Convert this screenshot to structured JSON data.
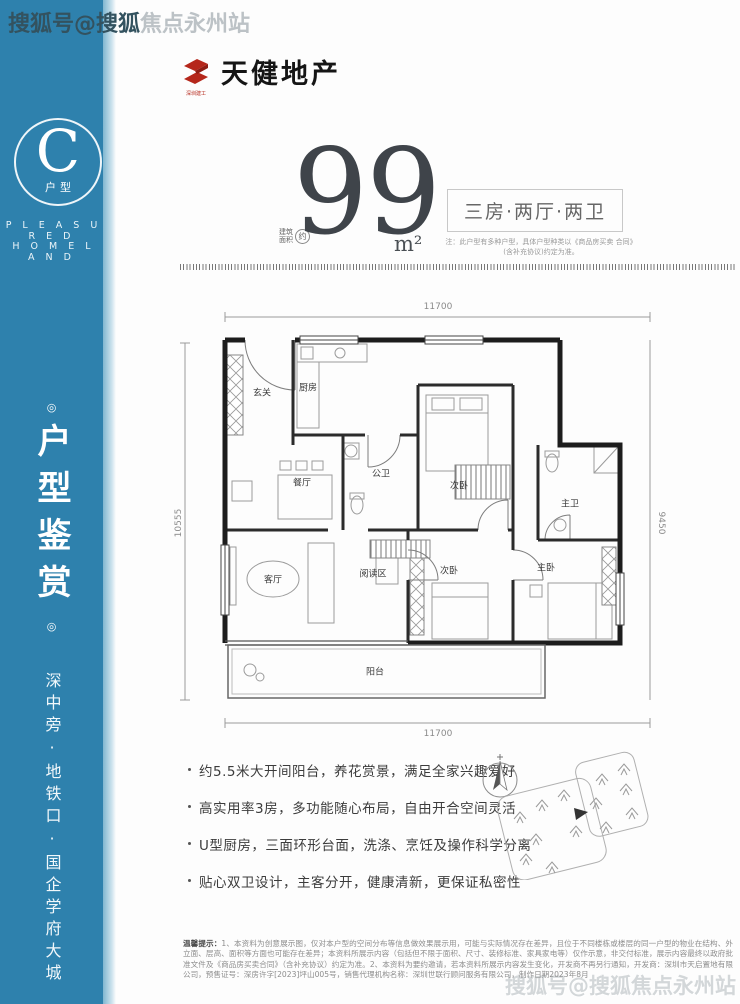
{
  "watermark": {
    "top_on_blue": "搜狐号@搜狐",
    "top_on_white": "焦点永州站",
    "bottom": "搜狐号@搜狐焦点永州站"
  },
  "header": {
    "logo_text": "天健地产",
    "logo_subtext": "深圳建工"
  },
  "sidebar": {
    "badge_letter": "C",
    "badge_label": "户型",
    "subtitle_line1": "P L E A S U R E D",
    "subtitle_line2": "H O M E L A N D",
    "ornament": "◎",
    "vertical_title": "户型鉴赏",
    "vertical_slogan": "深中旁·地铁口·国企学府大城"
  },
  "area": {
    "prefix_line1": "建筑",
    "prefix_line2": "面积",
    "prefix_circle": "约",
    "value": "99",
    "unit": "m²"
  },
  "layout_box": {
    "title": "三房·两厅·两卫",
    "note1": "注：此户型有多种户型，具体户型种类以《商品房买卖",
    "note2": "合同》(含补充协议)约定为准。"
  },
  "floorplan": {
    "dims": {
      "top": "11700",
      "bottom": "11700",
      "left": "10555",
      "right": "9450"
    },
    "rooms": [
      "玄关",
      "厨房",
      "公卫",
      "餐厅",
      "次卧",
      "主卫",
      "主卧",
      "次卧",
      "客厅",
      "阅读区",
      "阳台"
    ]
  },
  "features": [
    "约5.5米大开间阳台，养花赏景，满足全家兴趣爱好",
    "高实用率3房，多功能随心布局，自由开合空间灵活",
    "U型厨房，三面环形台面，洗涤、烹饪及操作科学分离",
    "贴心双卫设计，主客分开，健康清新，更保证私密性"
  ],
  "disclaimer": {
    "label": "温馨提示：",
    "lines": [
      "1、本资料为创意展示图，仅对本户型的空间分布等信息做效果展示用，可能与实际情况存在差异，且位于不同楼栋或楼层的同一户型的物业在结构、外立面、层",
      "高、面积等方面也可能存在差异；本资料所展示内容（包括但不限于面积、尺寸、装修标准、家具家电等）仅作示意，非交付标准，展示内容最终以政府批准文件及《商品",
      "房买卖合同》（含补充协议）约定为准。2、本资料为要约邀请，若本资料所展示内容发生变化，开发商不再另行通知，开发商：深圳市天启置地有限公司，预售证号：深房",
      "许字[2023]坪山005号，销售代理机构名称：深圳世联行顾问服务有限公司，制作日期2023年8月"
    ]
  },
  "colors": {
    "sidebar_blue": "#2e81ad",
    "logo_red": "#b5271b",
    "wall_black": "#1d1d1d",
    "headline_gray": "#3f444a"
  }
}
